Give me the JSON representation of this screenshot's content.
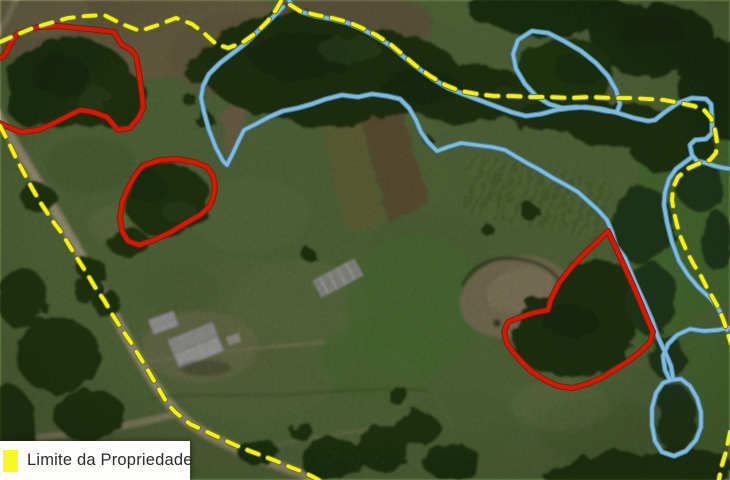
{
  "map": {
    "kind": "aerial-photo-with-property-annotations",
    "legend": {
      "items": [
        {
          "label": "Limite da Propriedade",
          "swatch_color": "#f8f822"
        }
      ]
    },
    "overlay_layers": [
      {
        "name": "watercourse-riparian-outline",
        "color": "#84b9d9",
        "halo_color": "#3e7d9e",
        "stroke_width": 3.4,
        "halo_width": 5.6,
        "shapes": [
          {
            "closed": false,
            "points": "287,-4 292,6 302,12 316,16 332,19 348,23 362,29 377,37 391,46 404,57 418,68 433,79 448,88 463,94 479,100 495,106 511,112 526,116 541,114 556,110 571,108 586,107 602,109 618,113 634,118 648,121 655,120 665,112 678,103 692,98 706,99 711,104 712,118 712,133 706,139 695,140 690,145 692,155 697,161 706,163 715,166 724,168 732,169"
          },
          {
            "closed": false,
            "points": "692,157 684,163 676,169 669,179 665,192 664,205 667,222 672,242 679,261 688,275 698,287 709,297 717,306 723,318 727,330"
          },
          {
            "closed": false,
            "points": "732,327 718,330 704,331 690,329 677,335 668,344 663,356 665,370 669,378"
          },
          {
            "closed": false,
            "points": "283,7 272,18 259,30 246,43 233,53 220,63 209,74 203,86 201,98 204,112 209,130 216,148 223,161 227,165 233,153 239,140 244,130 256,124 269,117 283,111 298,108 312,104 326,99 342,95 358,97 372,94 387,96 400,99 409,108 416,120 421,132 428,142 437,151 448,147 461,143 476,145 492,147 505,150 515,156 527,163 540,170 553,178 566,185 578,192 588,201 598,210 607,220 612,232 616,246 625,258 634,280 644,302 652,320 658,337 665,352 671,366 673,378"
          },
          {
            "closed": true,
            "points": "518,40 532,31 548,33 564,41 581,51 596,63 608,76 616,90 620,104 617,112 606,111 591,108 576,107 562,108 549,104 536,96 525,84 516,69 513,54"
          },
          {
            "closed": true,
            "points": "671,380 681,379 690,386 697,398 701,412 701,427 696,440 686,451 674,456 662,452 655,441 652,425 652,408 656,393 663,383"
          }
        ]
      },
      {
        "name": "native-vegetation-outline",
        "color": "#cd1d06",
        "halo_color": "#8e1203",
        "stroke_width": 4.2,
        "halo_width": 6.0,
        "shapes": [
          {
            "closed": true,
            "points": "18,33 38,27 58,26 78,28 98,30 114,32 121,44 131,50 136,56 139,73 142,95 143,108 139,117 130,128 118,130 107,117 93,112 80,110 66,117 52,124 38,130 21,132 8,127 -5,121 -7,60 4,56 12,41"
          },
          {
            "closed": true,
            "points": "145,165 160,160 176,159 194,162 207,167 213,176 215,187 213,198 209,207 200,215 186,223 171,232 154,240 139,245 128,241 122,231 120,218 122,203 127,190 134,177 140,169"
          },
          {
            "closed": true,
            "points": "608,231 597,242 583,255 570,269 559,283 551,299 548,310 533,313 518,318 508,322 504,332 507,343 513,352 521,361 531,371 545,380 558,386 572,388 587,384 601,378 614,370 627,362 640,352 650,342 653,332 648,321 641,304 631,281 620,257"
          }
        ]
      },
      {
        "name": "property-boundary-line",
        "color": "#f2f118",
        "halo_color": "#757510",
        "stroke_width": 3.8,
        "halo_width": 5.8,
        "dash": "12 10",
        "shapes": [
          {
            "closed": false,
            "points": "0,42 16,35 33,28 50,23 68,18 86,16 104,15 122,24 140,31 158,25 176,18 192,24 205,34 216,44 228,48 242,43 256,33 268,21 276,10 281,1 287,3 300,11 316,15 332,18 348,22 362,28 376,35 390,44 403,55 416,66 430,76 445,85 460,91 477,94 494,96 512,96 530,97 550,97 570,98 590,97 610,98 630,98 648,99 664,100 680,103 694,106 704,110 711,118 715,130 717,142 716,153 710,160 700,163 689,168 678,177 673,188 672,200 674,212 677,225 681,238 687,252 694,265 701,276 707,288 713,298 718,307 723,319 727,331 731,344"
          },
          {
            "closed": false,
            "points": "730,432 726,452 722,465 719,479"
          },
          {
            "closed": false,
            "points": "0,126 8,141 16,158 25,175 33,190 42,205 52,220 61,232 69,245 77,258 86,272 95,287 104,300 112,314 121,328 130,341 138,354 146,367 153,379 160,391 167,403 175,412 190,424 205,431 220,438 235,445 250,451 263,456 276,461 290,467 303,472 315,478 322,482"
          }
        ]
      }
    ]
  }
}
